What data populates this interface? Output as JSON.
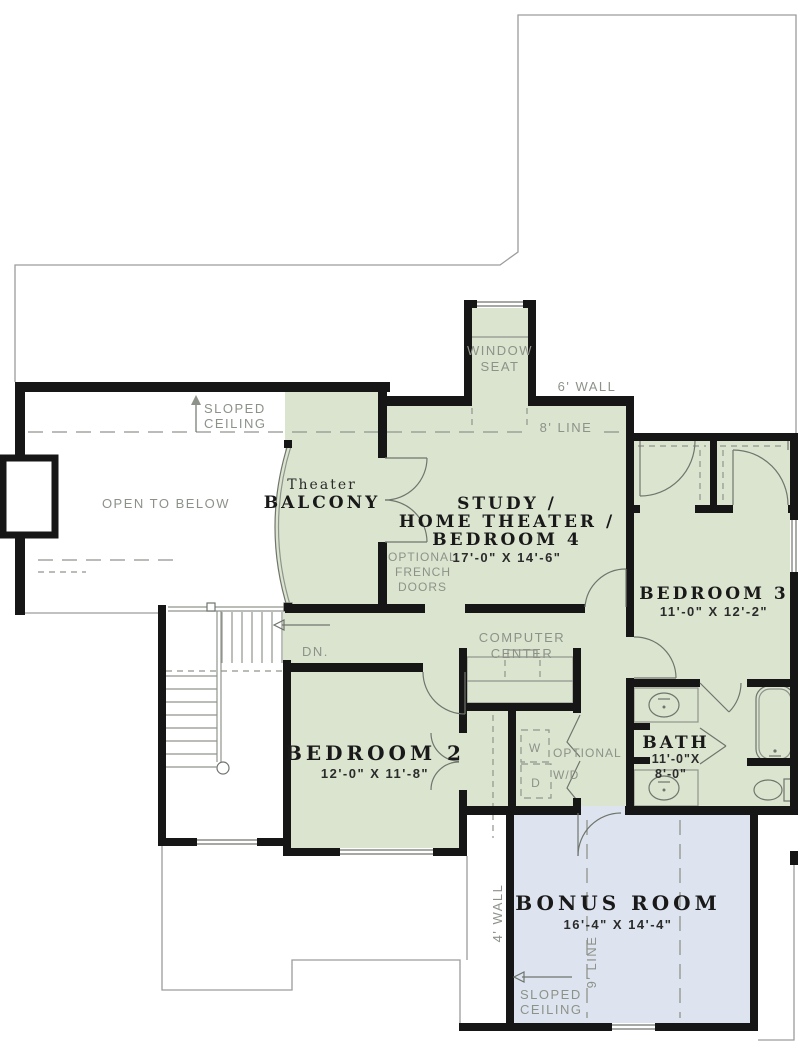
{
  "colors": {
    "room_fill": "#dbe4cf",
    "bonus_fill": "#dee4ef",
    "wall": "#161616",
    "roof_line": "#9c9c9c",
    "label_gray": "#8d9289",
    "text_dark": "#191919"
  },
  "rooms": {
    "balcony": {
      "pre": "Theater",
      "name": "BALCONY"
    },
    "study": {
      "line1": "STUDY /",
      "line2": "HOME THEATER /",
      "line3": "BEDROOM 4",
      "dims": "17'-0\" X 14'-6\""
    },
    "bedroom3": {
      "name": "BEDROOM 3",
      "dims": "11'-0\" X 12'-2\""
    },
    "bedroom2": {
      "name": "BEDROOM 2",
      "dims": "12'-0\" X 11'-8\""
    },
    "bath": {
      "name": "BATH",
      "dims1": "11'-0\"X",
      "dims2": "8'-0\""
    },
    "bonus": {
      "name": "BONUS ROOM",
      "dims": "16'-4\" X 14'-4\""
    },
    "open_to_below": "OPEN TO BELOW"
  },
  "annotations": {
    "window_seat": [
      "WINDOW",
      "SEAT"
    ],
    "six_wall": "6' WALL",
    "eight_line": "8' LINE",
    "sloped_ceiling_top": [
      "SLOPED",
      "CEILING"
    ],
    "sloped_ceiling_bottom": [
      "SLOPED",
      "CEILING"
    ],
    "four_wall": "4' WALL",
    "nine_line": "9' LINE",
    "dn": "DN.",
    "computer_center": [
      "COMPUTER",
      "CENTER"
    ],
    "optional_french": [
      "OPTIONAL",
      "FRENCH",
      "DOORS"
    ],
    "optional_wd": [
      "OPTIONAL",
      "W/D"
    ],
    "washer": "W",
    "dryer": "D"
  }
}
